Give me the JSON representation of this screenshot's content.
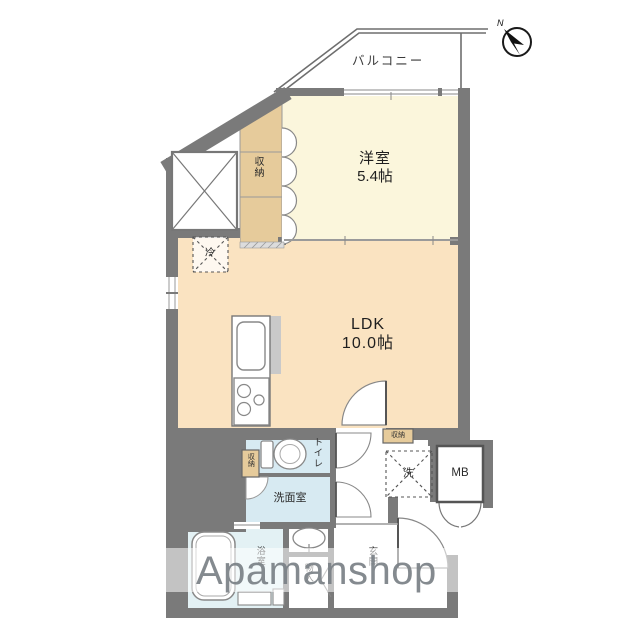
{
  "balcony": {
    "label": "バルコニー"
  },
  "compass": {
    "label": "N"
  },
  "rooms": {
    "western_room": {
      "name": "洋室",
      "size": "5.4帖"
    },
    "ldk": {
      "name": "LDK",
      "size": "10.0帖"
    },
    "closet_main": {
      "label": "収納"
    },
    "refrigerator": {
      "label": "冷"
    },
    "toilet": {
      "label": "トイレ"
    },
    "washroom": {
      "label": "洗面室"
    },
    "storage_small_left": {
      "label": "収納"
    },
    "storage_small_hall": {
      "label": "収納"
    },
    "washer": {
      "label": "洗"
    },
    "meter_box": {
      "label": "MB"
    },
    "bathroom": {
      "label": "浴室"
    },
    "closet_entrance": {
      "label": "物入"
    },
    "entrance": {
      "label": "玄関"
    }
  },
  "watermark": {
    "text": "Apamanshop"
  },
  "colors": {
    "wall": "#7a7a7a",
    "western_room_fill": "#fbf6dc",
    "ldk_fill": "#fae3c1",
    "closet_fill": "#e6cb9b",
    "wet_room_fill": "#d7eaf2",
    "bath_fill": "#e3f1f4",
    "watermark_text": "#7a8086"
  }
}
